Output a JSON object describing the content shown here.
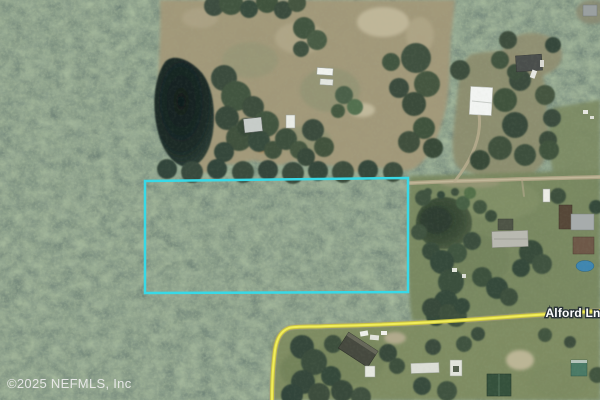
{
  "map": {
    "type": "aerial-satellite-photo",
    "watermark": "©2025 NEFMLS, Inc",
    "road_label": "Alford Ln",
    "colors": {
      "parcel_outline": "#38d9e6",
      "road_highlight_outer": "#cfc93e",
      "road_highlight_inner": "#f2ef5c",
      "label_text": "#ffffff",
      "watermark_text": "#ebebeb"
    }
  }
}
